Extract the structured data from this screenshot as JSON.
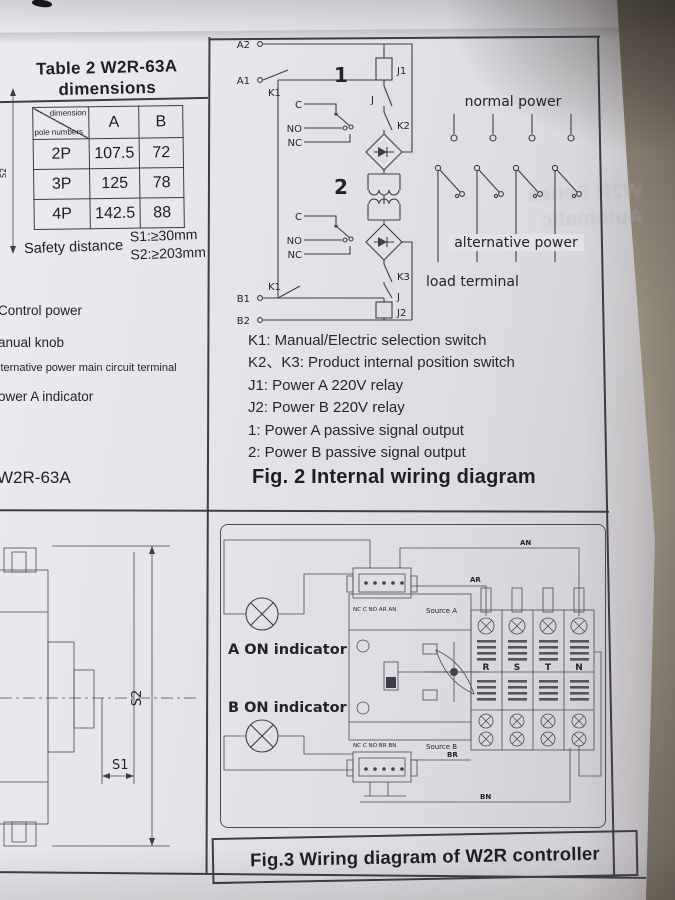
{
  "page": {
    "ghost_text": "W2R Series Automatic",
    "fig2_caption": "Fig. 2 Internal wiring diagram",
    "fig3_caption": "Fig.3 Wiring diagram of W2R controller"
  },
  "table2": {
    "title": "Table 2  W2R-63A",
    "subtitle": "dimensions",
    "header": {
      "dimension": "dimension",
      "pole_numbers": "pole numbers",
      "a": "A",
      "b": "B"
    },
    "rows": [
      [
        "2P",
        "107.5",
        "72"
      ],
      [
        "3P",
        "125",
        "78"
      ],
      [
        "4P",
        "142.5",
        "88"
      ]
    ],
    "safety": {
      "label": "Safety distance",
      "s1": "S1:≥30mm",
      "s2": "S2:≥203mm"
    }
  },
  "callouts": {
    "c1": "Control power",
    "c2": "anual  knob",
    "c3": "lternative power main circuit terminal",
    "c4": "ower A indicator",
    "model": "W2R-63A"
  },
  "fig2": {
    "terminals": {
      "a2": "A2",
      "a1": "A1",
      "b1": "B1",
      "b2": "B2"
    },
    "switches": {
      "k1_top": "K1",
      "k1_bot": "K1",
      "k2": "K2",
      "k3": "K3",
      "j_top": "J",
      "j_bot": "J"
    },
    "relays": {
      "j1": "J1",
      "j2": "J2"
    },
    "contacts": {
      "g1": {
        "num": "1",
        "c": "C",
        "no": "NO",
        "nc": "NC"
      },
      "g2": {
        "num": "2",
        "c": "C",
        "no": "NO",
        "nc": "NC"
      }
    },
    "sections": {
      "normal_power": "normal power",
      "alternative_power": "alternative power",
      "load_terminal": "load terminal"
    },
    "legend": [
      "K1: Manual/Electric selection switch",
      "K2、K3: Product internal position switch",
      "J1: Power A 220V relay",
      "J2: Power B 220V relay",
      "1: Power A passive signal output",
      "2: Power B passive signal output"
    ]
  },
  "dims": {
    "s1": "S1",
    "s2": "S2",
    "s2_side": "S2"
  },
  "fig3": {
    "a_on": "A ON indicator",
    "b_on": "B ON indicator",
    "strip_a": {
      "pins": "NC C NO AR AN",
      "source": "Source A"
    },
    "strip_b": {
      "pins": "NC C NO BR BN",
      "source": "Source B"
    },
    "wires": {
      "an": "AN",
      "ar": "AR",
      "br": "BR",
      "bn": "BN"
    },
    "poles": [
      "R",
      "S",
      "T",
      "N"
    ]
  }
}
